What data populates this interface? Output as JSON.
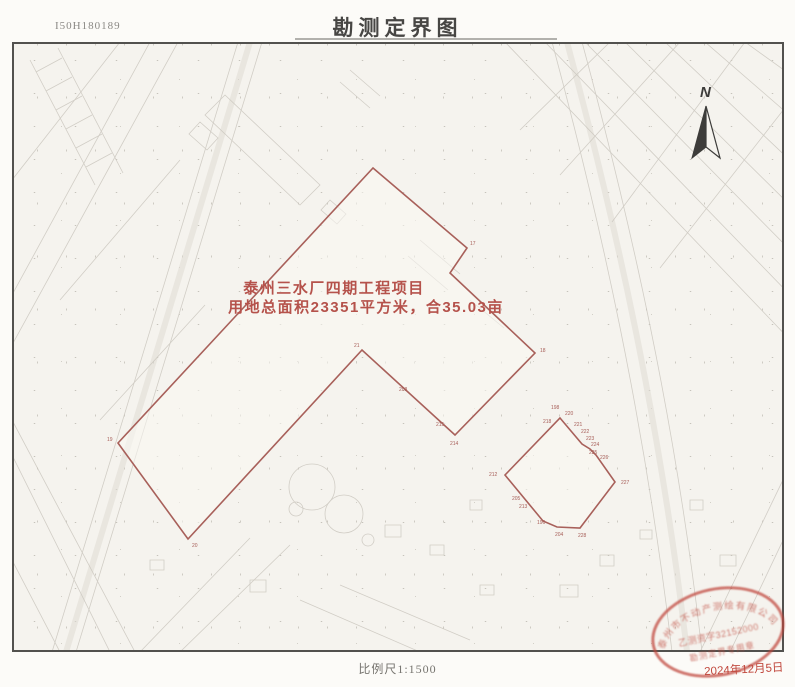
{
  "header": {
    "sheet_no": "I50H180189",
    "title": "勘测定界图"
  },
  "map": {
    "annotation_line1": "泰州三水厂四期工程项目",
    "annotation_line2": "用地总面积23351平方米，合35.03亩",
    "north_label": "N",
    "boundary_color": "#a8605a",
    "main_parcel_points": "373,168 467,248 450,273 535,353 455,435 362,350 188,539 118,443",
    "small_parcel_points": "560,418 582,444 590,449 596,455 615,482 580,528 557,527 543,521 505,475",
    "vertex_labels": [
      {
        "t": "17",
        "x": 470,
        "y": 245
      },
      {
        "t": "18",
        "x": 540,
        "y": 352
      },
      {
        "t": "21",
        "x": 354,
        "y": 347
      },
      {
        "t": "208",
        "x": 399,
        "y": 391
      },
      {
        "t": "215",
        "x": 436,
        "y": 426
      },
      {
        "t": "214",
        "x": 450,
        "y": 445
      },
      {
        "t": "19",
        "x": 107,
        "y": 441
      },
      {
        "t": "20",
        "x": 192,
        "y": 547
      },
      {
        "t": "198",
        "x": 551,
        "y": 409
      },
      {
        "t": "220",
        "x": 565,
        "y": 415
      },
      {
        "t": "218",
        "x": 543,
        "y": 423
      },
      {
        "t": "221",
        "x": 574,
        "y": 426
      },
      {
        "t": "222",
        "x": 581,
        "y": 433
      },
      {
        "t": "223",
        "x": 586,
        "y": 440
      },
      {
        "t": "224",
        "x": 591,
        "y": 446
      },
      {
        "t": "225",
        "x": 589,
        "y": 454
      },
      {
        "t": "226",
        "x": 600,
        "y": 459
      },
      {
        "t": "227",
        "x": 621,
        "y": 484
      },
      {
        "t": "212",
        "x": 489,
        "y": 476
      },
      {
        "t": "205",
        "x": 512,
        "y": 500
      },
      {
        "t": "213",
        "x": 519,
        "y": 508
      },
      {
        "t": "196",
        "x": 537,
        "y": 524
      },
      {
        "t": "204",
        "x": 555,
        "y": 536
      },
      {
        "t": "228",
        "x": 578,
        "y": 537
      }
    ]
  },
  "stamp": {
    "arc_text": "泰州市不动产测绘有限公司",
    "license": "乙测资字32152000",
    "caption": "勘测定界专用章",
    "date": "2024年12月5日"
  },
  "footer": {
    "scale_label": "比例尺1:1500"
  }
}
